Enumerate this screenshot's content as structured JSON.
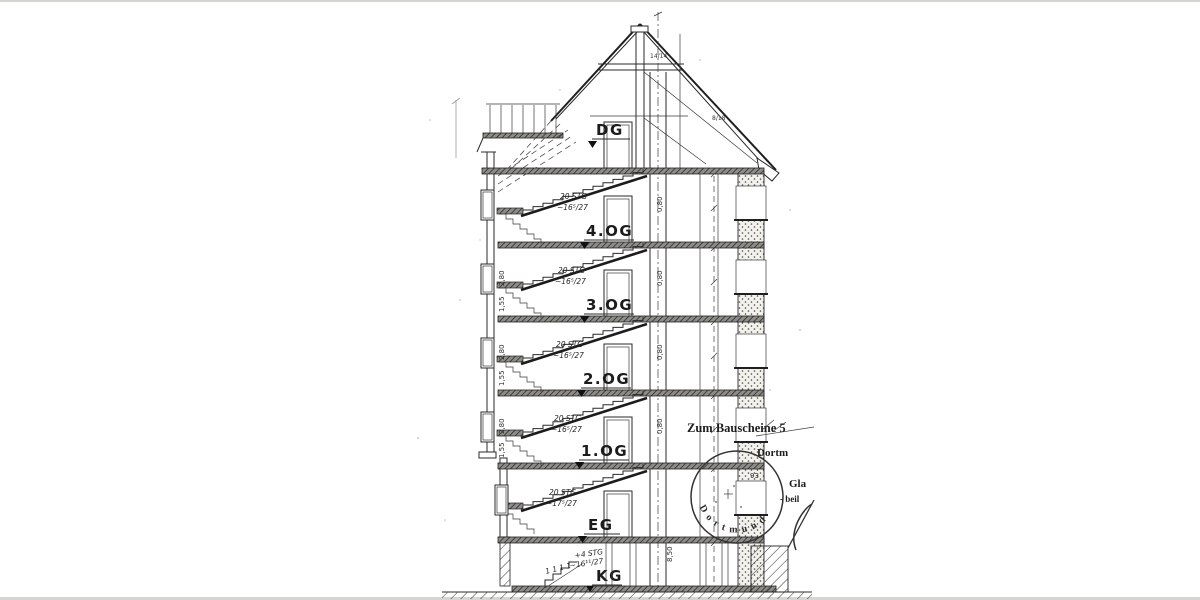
{
  "drawing": {
    "floor_labels": [
      {
        "label": "DG"
      },
      {
        "label": "4.OG"
      },
      {
        "label": "3.OG"
      },
      {
        "label": "2.OG"
      },
      {
        "label": "1.OG"
      },
      {
        "label": "EG"
      },
      {
        "label": "KG"
      }
    ],
    "stair_notes": [
      {
        "steps": "20 STG",
        "ratio": "~16⁵/27"
      },
      {
        "steps": "20 STG",
        "ratio": "~16⁵/27"
      },
      {
        "steps": "20 STG",
        "ratio": "~16⁵/27"
      },
      {
        "steps": "20 STG",
        "ratio": "~16⁵/27"
      },
      {
        "steps": "20 STG",
        "ratio": "~17⁵/27"
      },
      {
        "steps": "+4 STG",
        "ratio": "~16¹¹/27"
      }
    ],
    "dimensions": {
      "shaft_width": "0,80",
      "building_height": "8,50",
      "room_height": "2,80",
      "parapet_height": "1,55",
      "rafter_size": "14/14",
      "beam_size": "8/18",
      "margin_marks": "1 1 1 1"
    },
    "stamp": {
      "annotation": "Zum Bauscheine 5",
      "city_fraktur": "Dortm",
      "stamp_city": "Dortmund",
      "stamp_number": "93",
      "side_text_1": "Gla",
      "side_text_2": "- beil"
    }
  }
}
